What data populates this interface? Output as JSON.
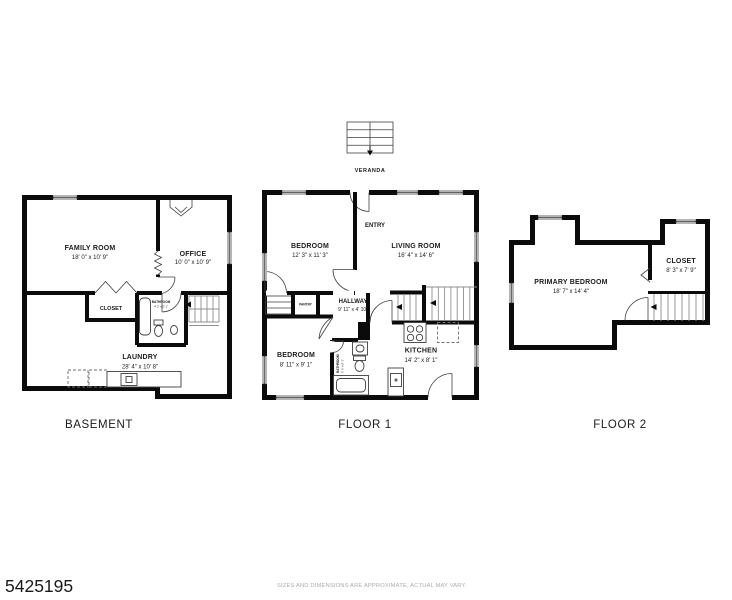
{
  "footer": {
    "listing_id": "5425195",
    "disclaimer": "SIZES AND DIMENSIONS ARE APPROXIMATE, ACTUAL MAY VARY."
  },
  "colors": {
    "wall": "#0b0b0b",
    "detail_line": "#3f3f3f",
    "stair_line": "#8f8f8f",
    "text": "#1c1c1c",
    "muted_text": "#adadad",
    "background": "#ffffff"
  },
  "floors": {
    "basement": {
      "label": "BASEMENT",
      "rooms": {
        "family_room": {
          "name": "FAMILY ROOM",
          "dims": "18' 0\" x 10' 9\""
        },
        "office": {
          "name": "OFFICE",
          "dims": "10' 0\" x 10' 9\""
        },
        "closet": {
          "name": "CLOSET"
        },
        "bathroom": {
          "name": "BATHROOM",
          "dims": "4' 2\" x 5' 1\""
        },
        "laundry": {
          "name": "LAUNDRY",
          "dims": "28' 4\" x 10' 8\""
        }
      }
    },
    "floor1": {
      "label": "FLOOR 1",
      "veranda_label": "VERANDA",
      "rooms": {
        "bedroom_top": {
          "name": "BEDROOM",
          "dims": "12' 3\" x 11' 3\""
        },
        "entry": {
          "name": "ENTRY"
        },
        "living_room": {
          "name": "LIVING ROOM",
          "dims": "16' 4\" x 14' 6\""
        },
        "pantry": {
          "name": "PANTRY"
        },
        "hallway": {
          "name": "HALLWAY",
          "dims": "9' 11\" x 4' 10\""
        },
        "bedroom_bottom": {
          "name": "BEDROOM",
          "dims": "8' 11\" x 9' 1\""
        },
        "bathroom": {
          "name": "BATHROOM",
          "dims": "5' 0\" x 8' 1\""
        },
        "kitchen": {
          "name": "KITCHEN",
          "dims": "14' 2\" x 8' 1\""
        }
      }
    },
    "floor2": {
      "label": "FLOOR 2",
      "rooms": {
        "primary_bedroom": {
          "name": "PRIMARY BEDROOM",
          "dims": "18' 7\" x 14' 4\""
        },
        "closet": {
          "name": "CLOSET",
          "dims": "8' 3\" x 7' 9\""
        }
      }
    }
  }
}
